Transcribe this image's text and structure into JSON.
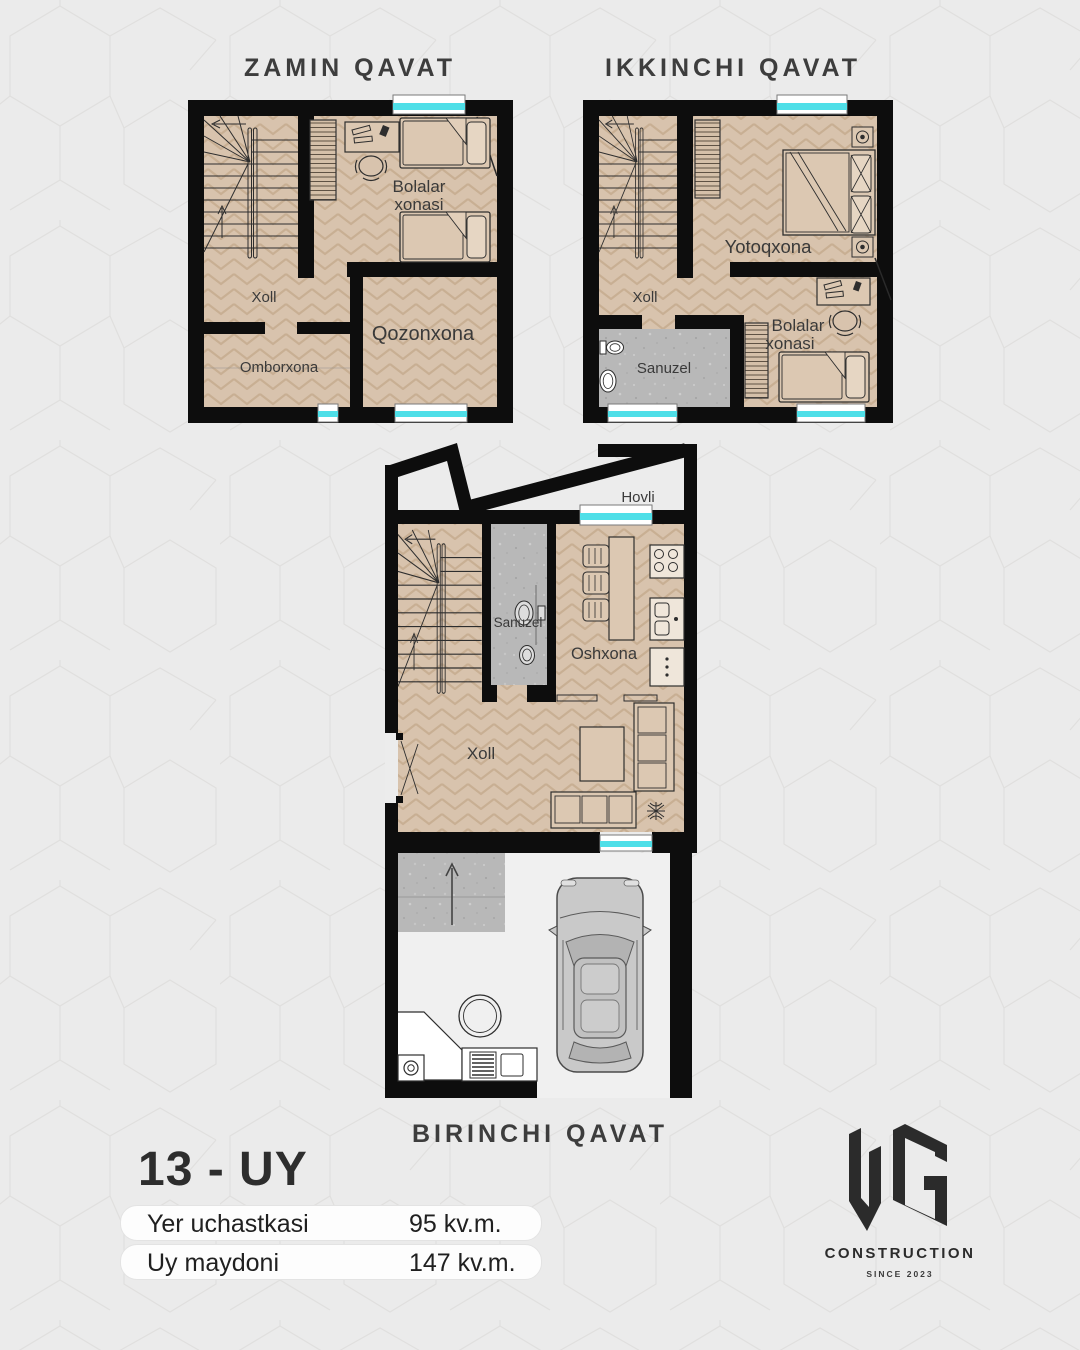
{
  "page": {
    "background": "#ebebeb",
    "pattern_line_color": "#e0dfde"
  },
  "plans": {
    "zamin": {
      "title": "ZAMIN QAVAT",
      "rooms": {
        "bolalar_line1": "Bolalar",
        "bolalar_line2": "xonasi",
        "xoll": "Xoll",
        "omborxona": "Omborxona",
        "qozonxona": "Qozonxona"
      }
    },
    "ikkinchi": {
      "title": "IKKINCHI QAVAT",
      "rooms": {
        "yotoqxona": "Yotoqxona",
        "xoll": "Xoll",
        "sanuzel": "Sanuzel",
        "bolalar_line1": "Bolalar",
        "bolalar_line2": "xonasi"
      }
    },
    "birinchi": {
      "title": "BIRINCHI QAVAT",
      "rooms": {
        "hovli": "Hovli",
        "sanuzel": "Sanuzel",
        "oshxona": "Oshxona",
        "xoll": "Xoll"
      }
    }
  },
  "info": {
    "house_number": "13 - UY",
    "rows": [
      {
        "label": "Yer uchastkasi",
        "value": "95 kv.m."
      },
      {
        "label": "Uy maydoni",
        "value": "147 kv.m."
      }
    ]
  },
  "logo": {
    "monogram": "UG",
    "name": "CONSTRUCTION",
    "since": "SINCE 2023"
  },
  "colors": {
    "wall": "#0d0d0d",
    "floor_wood": "#d8c3ad",
    "tile_gray": "#b8b8b8",
    "window_glass": "#4fdfe8",
    "garage_floor": "#f0f0f0",
    "text": "#3a3a3a",
    "pill_bg": "#fdfdfd",
    "logo_ink": "#2b2b2b"
  }
}
